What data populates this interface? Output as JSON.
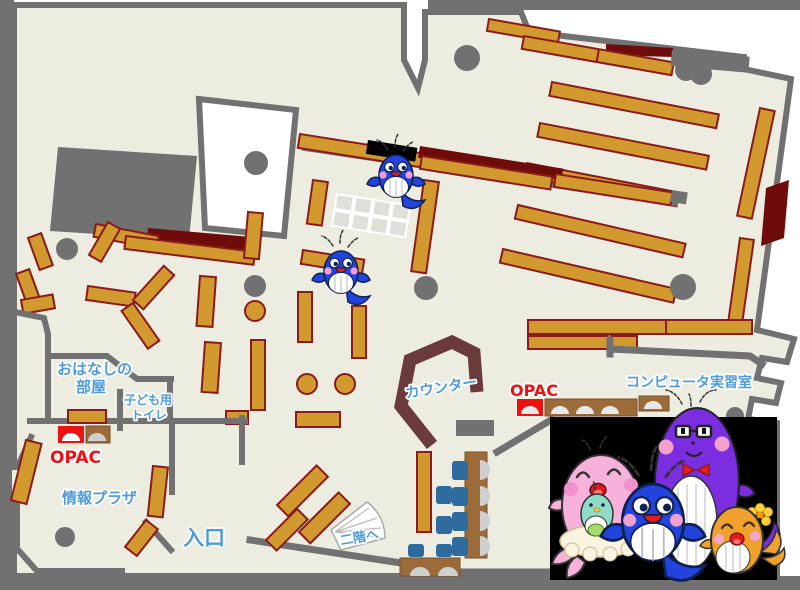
{
  "title": "library-floor-map",
  "labels": {
    "storytelling_room": {
      "line1": "おはなしの",
      "line2": "部屋"
    },
    "kids_toilet": {
      "line1": "子ども用",
      "line2": "トイレ"
    },
    "opac_left": "OPAC",
    "opac_right": "OPAC",
    "info_plaza": "情報プラザ",
    "entrance": "入口",
    "counter": "カウンター",
    "stairs_up": "二階へ",
    "computer_room": "コンピュータ実習室"
  },
  "colors": {
    "floor": "#ecece0",
    "wall": "#717171",
    "shelf": "#d2992e",
    "shelf_border": "#8b1a1a",
    "accent_dark_red": "#6e0b0b",
    "counter": "#6b3a3a",
    "chair_blue": "#2e6b9e",
    "desk_brown": "#9c6b3a",
    "opac_red": "#ee1111",
    "label_blue": "#4e9bdc",
    "photo_background": "#000000",
    "whale_blue": "#2244dd",
    "whale_purple": "#7a2ee0",
    "whale_pink": "#f7b2dc",
    "whale_orange": "#f0a02c",
    "whale_teal": "#8edcc8"
  },
  "mascots": {
    "map": [
      "blue-whale",
      "blue-whale"
    ],
    "photo": [
      "pink-whale-mother",
      "teal-whale-baby",
      "blue-whale-child",
      "purple-whale-father",
      "orange-whale-child"
    ]
  }
}
